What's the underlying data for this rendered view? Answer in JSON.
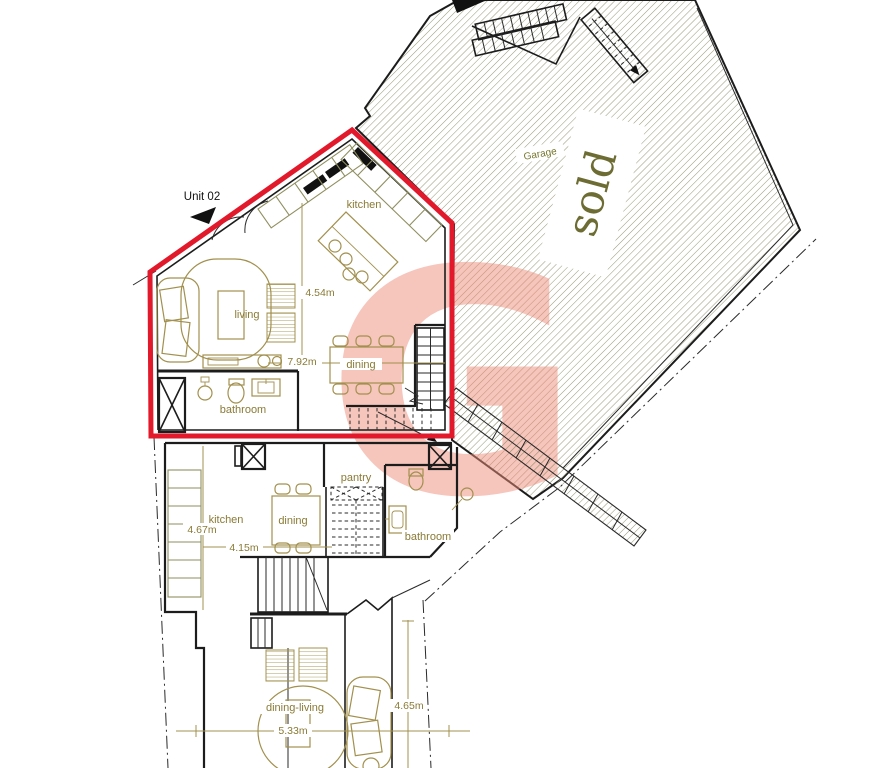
{
  "plan": {
    "unit02": {
      "name": "Unit 02",
      "rooms": {
        "kitchen": "kitchen",
        "living": "living",
        "dining": "dining",
        "bathroom": "bathroom"
      },
      "dims": {
        "d454": "4.54m",
        "d792": "7.92m"
      }
    },
    "garage": {
      "name": "Garage",
      "status": "sold"
    },
    "watermark": {
      "letter": "G"
    },
    "first_floor": {
      "rooms": {
        "kitchen": "kitchen",
        "dining": "dining",
        "pantry": "pantry",
        "bathroom": "bathroom"
      },
      "dims": {
        "d467": "4.67m",
        "d415": "4.15m"
      }
    },
    "ground_floor": {
      "rooms": {
        "dining_living": "dining-living"
      },
      "dims": {
        "d533": "5.33m",
        "d465": "4.65m"
      }
    },
    "colors": {
      "unit_outline": "#e2182b",
      "watermark": "#ee8c7a",
      "furniture": "#a2904e",
      "labels": "#8a7a35",
      "hatch": "#9a9a7a",
      "walls": "#1c1c1c"
    }
  }
}
